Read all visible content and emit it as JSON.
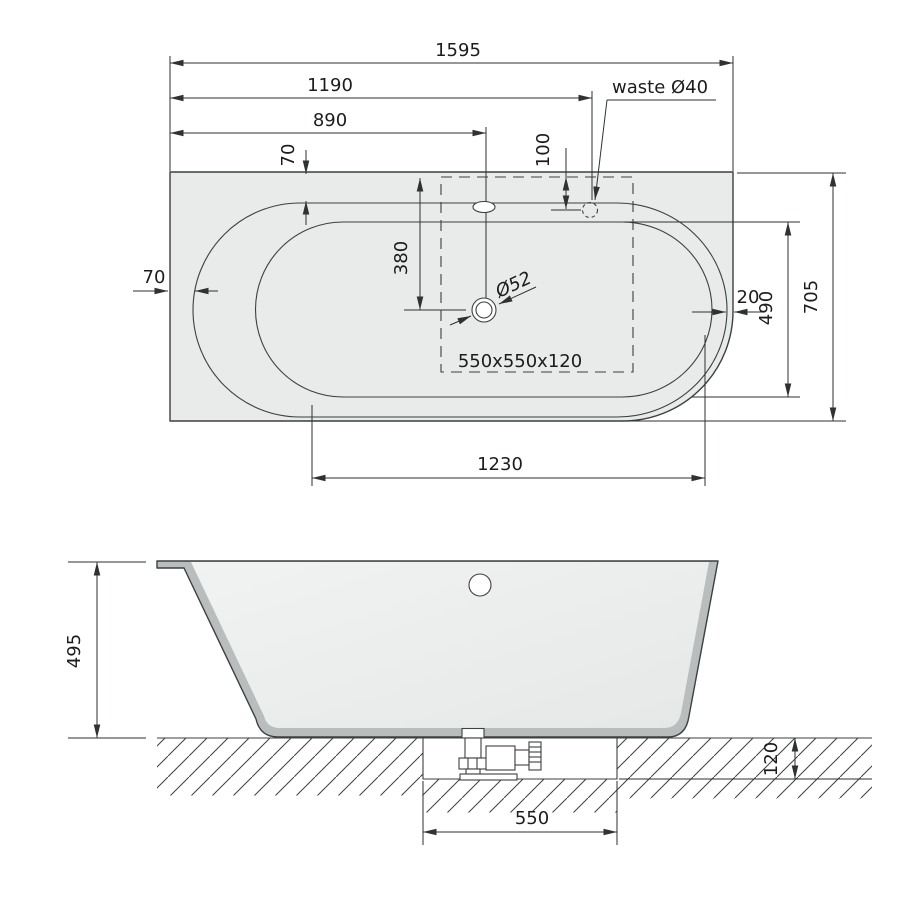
{
  "colors": {
    "background": "#ffffff",
    "tub_fill": "#e9eaea",
    "wall_fill": "#b9bdbd",
    "interior_fill": "#eceded",
    "line": "#3c4040",
    "dim": "#2e3232",
    "text": "#1b1d1d"
  },
  "top_view": {
    "dims": {
      "overall_length": "1595",
      "length_to_waste": "1190",
      "length_to_overflow": "890",
      "rim_inset_top": "70",
      "waste_from_edge": "100",
      "drain_from_edge": "380",
      "rim_inset_left": "70",
      "rim_inset_right": "20",
      "basin_width": "490",
      "overall_width": "705",
      "basin_length": "1230"
    },
    "labels": {
      "waste": "waste Ø40",
      "drain_diameter": "Ø52",
      "support_area": "550x550x120"
    }
  },
  "side_view": {
    "dims": {
      "height": "495",
      "recess_depth": "120",
      "recess_width": "550"
    }
  }
}
